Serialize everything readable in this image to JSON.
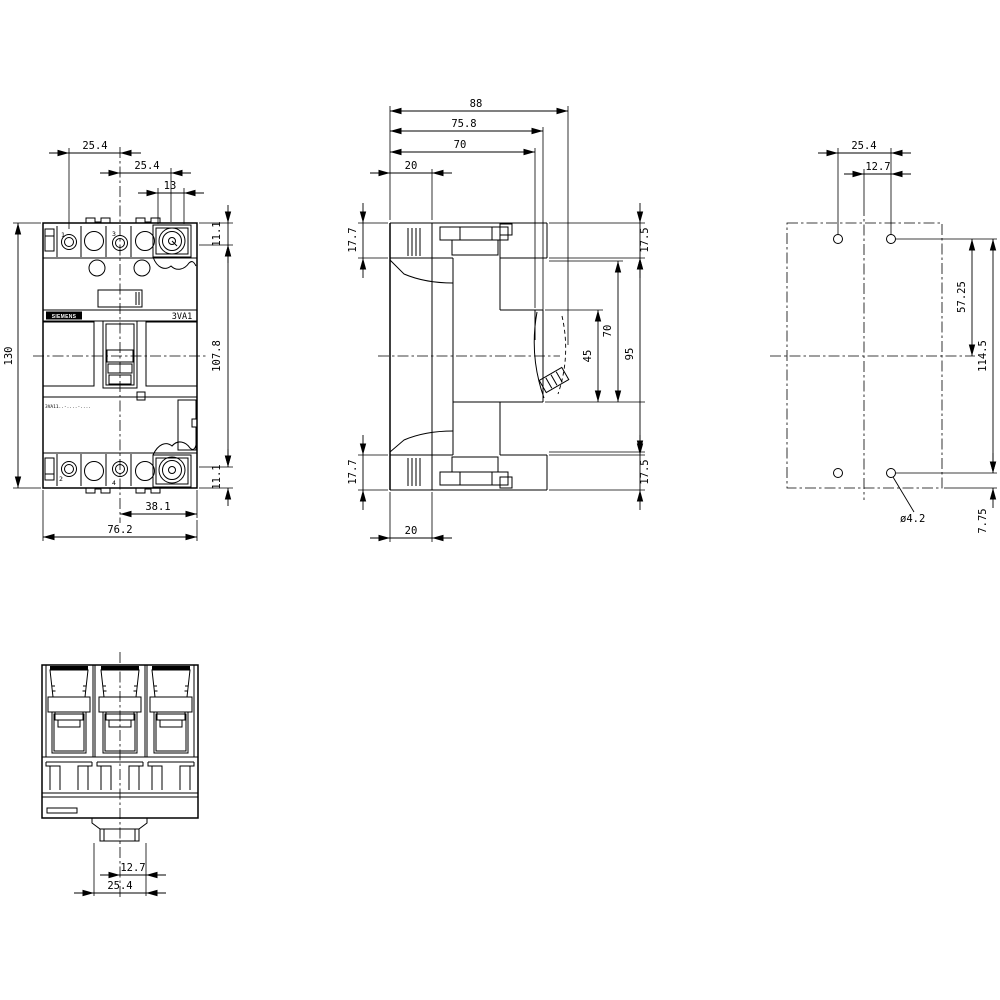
{
  "drawing": {
    "front_view": {
      "brand": "SIEMENS",
      "model": "3VA1",
      "type_code": "3VA11..-....-....",
      "terminals": {
        "t1": "1",
        "t2": "2",
        "t3": "3",
        "t4": "4"
      },
      "dims": {
        "pole_pitch_1_3": "25.4",
        "pole_pitch_3_5": "25.4",
        "terminal_opening": "13",
        "terminal_height_top": "11.1",
        "total_height": "130",
        "cover_height": "107.8",
        "terminal_height_bottom": "11.1",
        "center_to_edge": "38.1",
        "total_width": "76.2"
      }
    },
    "side_view": {
      "dims": {
        "total_depth": "88",
        "depth_to_escutcheon": "75.8",
        "depth_to_recess": "70",
        "base_depth_top": "20",
        "rail_height_top": "17.7",
        "front_step_top": "17.5",
        "handle_window": "45",
        "escutcheon_span": "70",
        "front_body_height": "95",
        "rail_height_bottom": "17.7",
        "front_step_bottom": "17.5",
        "base_depth_bottom": "20"
      }
    },
    "drilling_plan": {
      "dims": {
        "hole_pitch_horizontal": "25.4",
        "hole_to_center": "12.7",
        "hole_to_centerline": "57.25",
        "hole_pitch_vertical": "114.5",
        "hole_to_edge": "7.75",
        "hole_diameter": "ø4.2"
      }
    },
    "bottom_view": {
      "dims": {
        "foot_half_width": "12.7",
        "foot_width": "25.4"
      }
    }
  }
}
